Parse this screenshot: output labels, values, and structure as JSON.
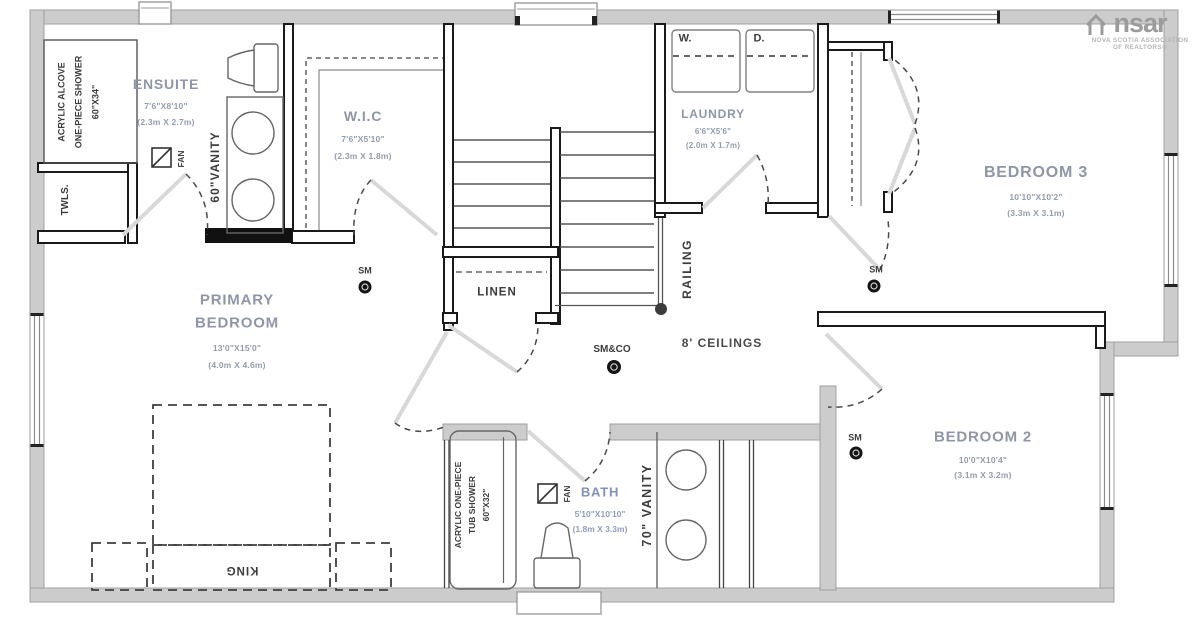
{
  "branding": {
    "logo_left": "ns",
    "logo_right": "ar",
    "tagline_line1": "NOVA SCOTIA ASSOCIATION",
    "tagline_line2": "OF REALTORS®"
  },
  "general": {
    "ceiling_note": "8' CEILINGS"
  },
  "rooms": {
    "ensuite": {
      "name": "ENSUITE",
      "dims_imperial": "7'6\"X8'10\"",
      "dims_metric": "(2.3m X 2.7m)"
    },
    "wic": {
      "name": "W.I.C",
      "dims_imperial": "7'6\"X5'10\"",
      "dims_metric": "(2.3m X 1.8m)"
    },
    "laundry": {
      "name": "LAUNDRY",
      "dims_imperial": "6'6\"X5'6\"",
      "dims_metric": "(2.0m X 1.7m)"
    },
    "bedroom3": {
      "name": "BEDROOM 3",
      "dims_imperial": "10'10\"X10'2\"",
      "dims_metric": "(3.3m X 3.1m)"
    },
    "primary": {
      "name_line1": "PRIMARY",
      "name_line2": "BEDROOM",
      "dims_imperial": "13'0\"X15'0\"",
      "dims_metric": "(4.0m X 4.6m)"
    },
    "bedroom2": {
      "name": "BEDROOM 2",
      "dims_imperial": "10'0\"X10'4\"",
      "dims_metric": "(3.1m X 3.2m)"
    },
    "bath": {
      "name": "BATH",
      "dims_imperial": "5'10\"X10'10\"",
      "dims_metric": "(1.8m X 3.3m)"
    },
    "linen": {
      "name": "LINEN"
    }
  },
  "labels": {
    "ensuite_shower_line1": "ACRYLIC ALCOVE",
    "ensuite_shower_line2": "ONE-PIECE SHOWER",
    "ensuite_shower_line3": "60\"X34\"",
    "tub_shower_line1": "ACRYLIC ONE-PIECE",
    "tub_shower_line2": "TUB SHOWER",
    "tub_shower_line3": "60\"X32\"",
    "ensuite_vanity": "60\"VANITY",
    "bath_vanity": "70\" VANITY",
    "fan": "FAN",
    "towels": "TWLS.",
    "washer": "W.",
    "dryer": "D.",
    "king_bed": "KING",
    "railing": "RAILING",
    "smoke_detector": "SM",
    "smoke_co_detector": "SM&CO"
  },
  "colors": {
    "wall_grey": "#cccccc",
    "room_label": "#8e96a7",
    "bath_label": "#8290b5",
    "line_dark": "#3c3c3c"
  }
}
